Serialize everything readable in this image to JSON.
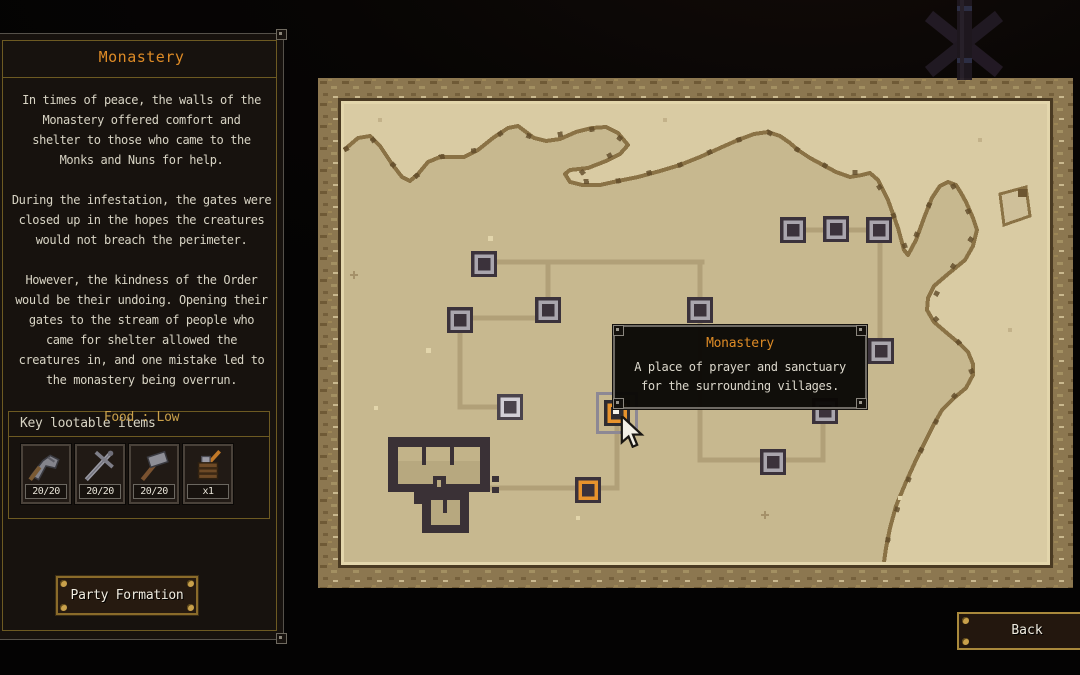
{
  "panel": {
    "title": "Monastery",
    "paragraphs": [
      [
        "In times of peace, the walls of the",
        "Monastery offered comfort and",
        "shelter to those who came to the",
        "Monks and Nuns for help."
      ],
      [
        "During the infestation, the gates were",
        "closed up in the hopes the creatures",
        "would not breach the perimeter."
      ],
      [
        "However, the kindness of the Order",
        "would be their undoing. Opening their",
        "gates to the stream of people who",
        "came for shelter allowed the",
        "creatures in, and one mistake led to",
        "the monastery being overrun."
      ]
    ],
    "food_label": "Food : Low",
    "loot": {
      "header": "Key lootable items",
      "items": [
        {
          "icon": "axe-icon",
          "count": "20/20"
        },
        {
          "icon": "sword-icon",
          "count": "20/20"
        },
        {
          "icon": "hammer-icon",
          "count": "20/20"
        },
        {
          "icon": "supplies-icon",
          "count": "x1"
        }
      ]
    },
    "party_button": "Party Formation"
  },
  "tooltip": {
    "title": "Monastery",
    "body_lines": [
      "A place of prayer and sanctuary",
      "for the surrounding villages."
    ]
  },
  "back_button": "Back",
  "map": {
    "nodes": [
      {
        "x": 166,
        "y": 186,
        "type": "normal"
      },
      {
        "x": 230,
        "y": 232,
        "type": "normal"
      },
      {
        "x": 142,
        "y": 242,
        "type": "normal"
      },
      {
        "x": 382,
        "y": 232,
        "type": "normal"
      },
      {
        "x": 475,
        "y": 152,
        "type": "normal"
      },
      {
        "x": 518,
        "y": 151,
        "type": "normal"
      },
      {
        "x": 561,
        "y": 152,
        "type": "normal"
      },
      {
        "x": 563,
        "y": 273,
        "type": "normal"
      },
      {
        "x": 507,
        "y": 333,
        "type": "normal"
      },
      {
        "x": 455,
        "y": 384,
        "type": "normal"
      },
      {
        "x": 192,
        "y": 329,
        "type": "visited"
      },
      {
        "x": 299,
        "y": 335,
        "type": "selected"
      },
      {
        "x": 270,
        "y": 412,
        "type": "objective"
      }
    ],
    "roads": [
      [
        166,
        184,
        384,
        184
      ],
      [
        230,
        184,
        230,
        232
      ],
      [
        382,
        184,
        382,
        232
      ],
      [
        155,
        240,
        219,
        240
      ],
      [
        142,
        242,
        142,
        329
      ],
      [
        142,
        329,
        192,
        329
      ],
      [
        299,
        335,
        299,
        410
      ],
      [
        172,
        410,
        299,
        410
      ],
      [
        382,
        232,
        382,
        382
      ],
      [
        382,
        382,
        505,
        382
      ],
      [
        505,
        333,
        505,
        382
      ],
      [
        475,
        152,
        561,
        152
      ],
      [
        562,
        152,
        562,
        273
      ]
    ]
  },
  "colors": {
    "accent_orange": "#de8b26",
    "gold_text": "#c9a04a",
    "parchment_sea": "#d9cba3",
    "parchment_land": "#c7b88f",
    "road": "#b1a078",
    "node_dark": "#3b323b",
    "node_ring": "#a9a5ad",
    "node_orange": "#e8932c",
    "selection_gray": "#8d8894"
  }
}
